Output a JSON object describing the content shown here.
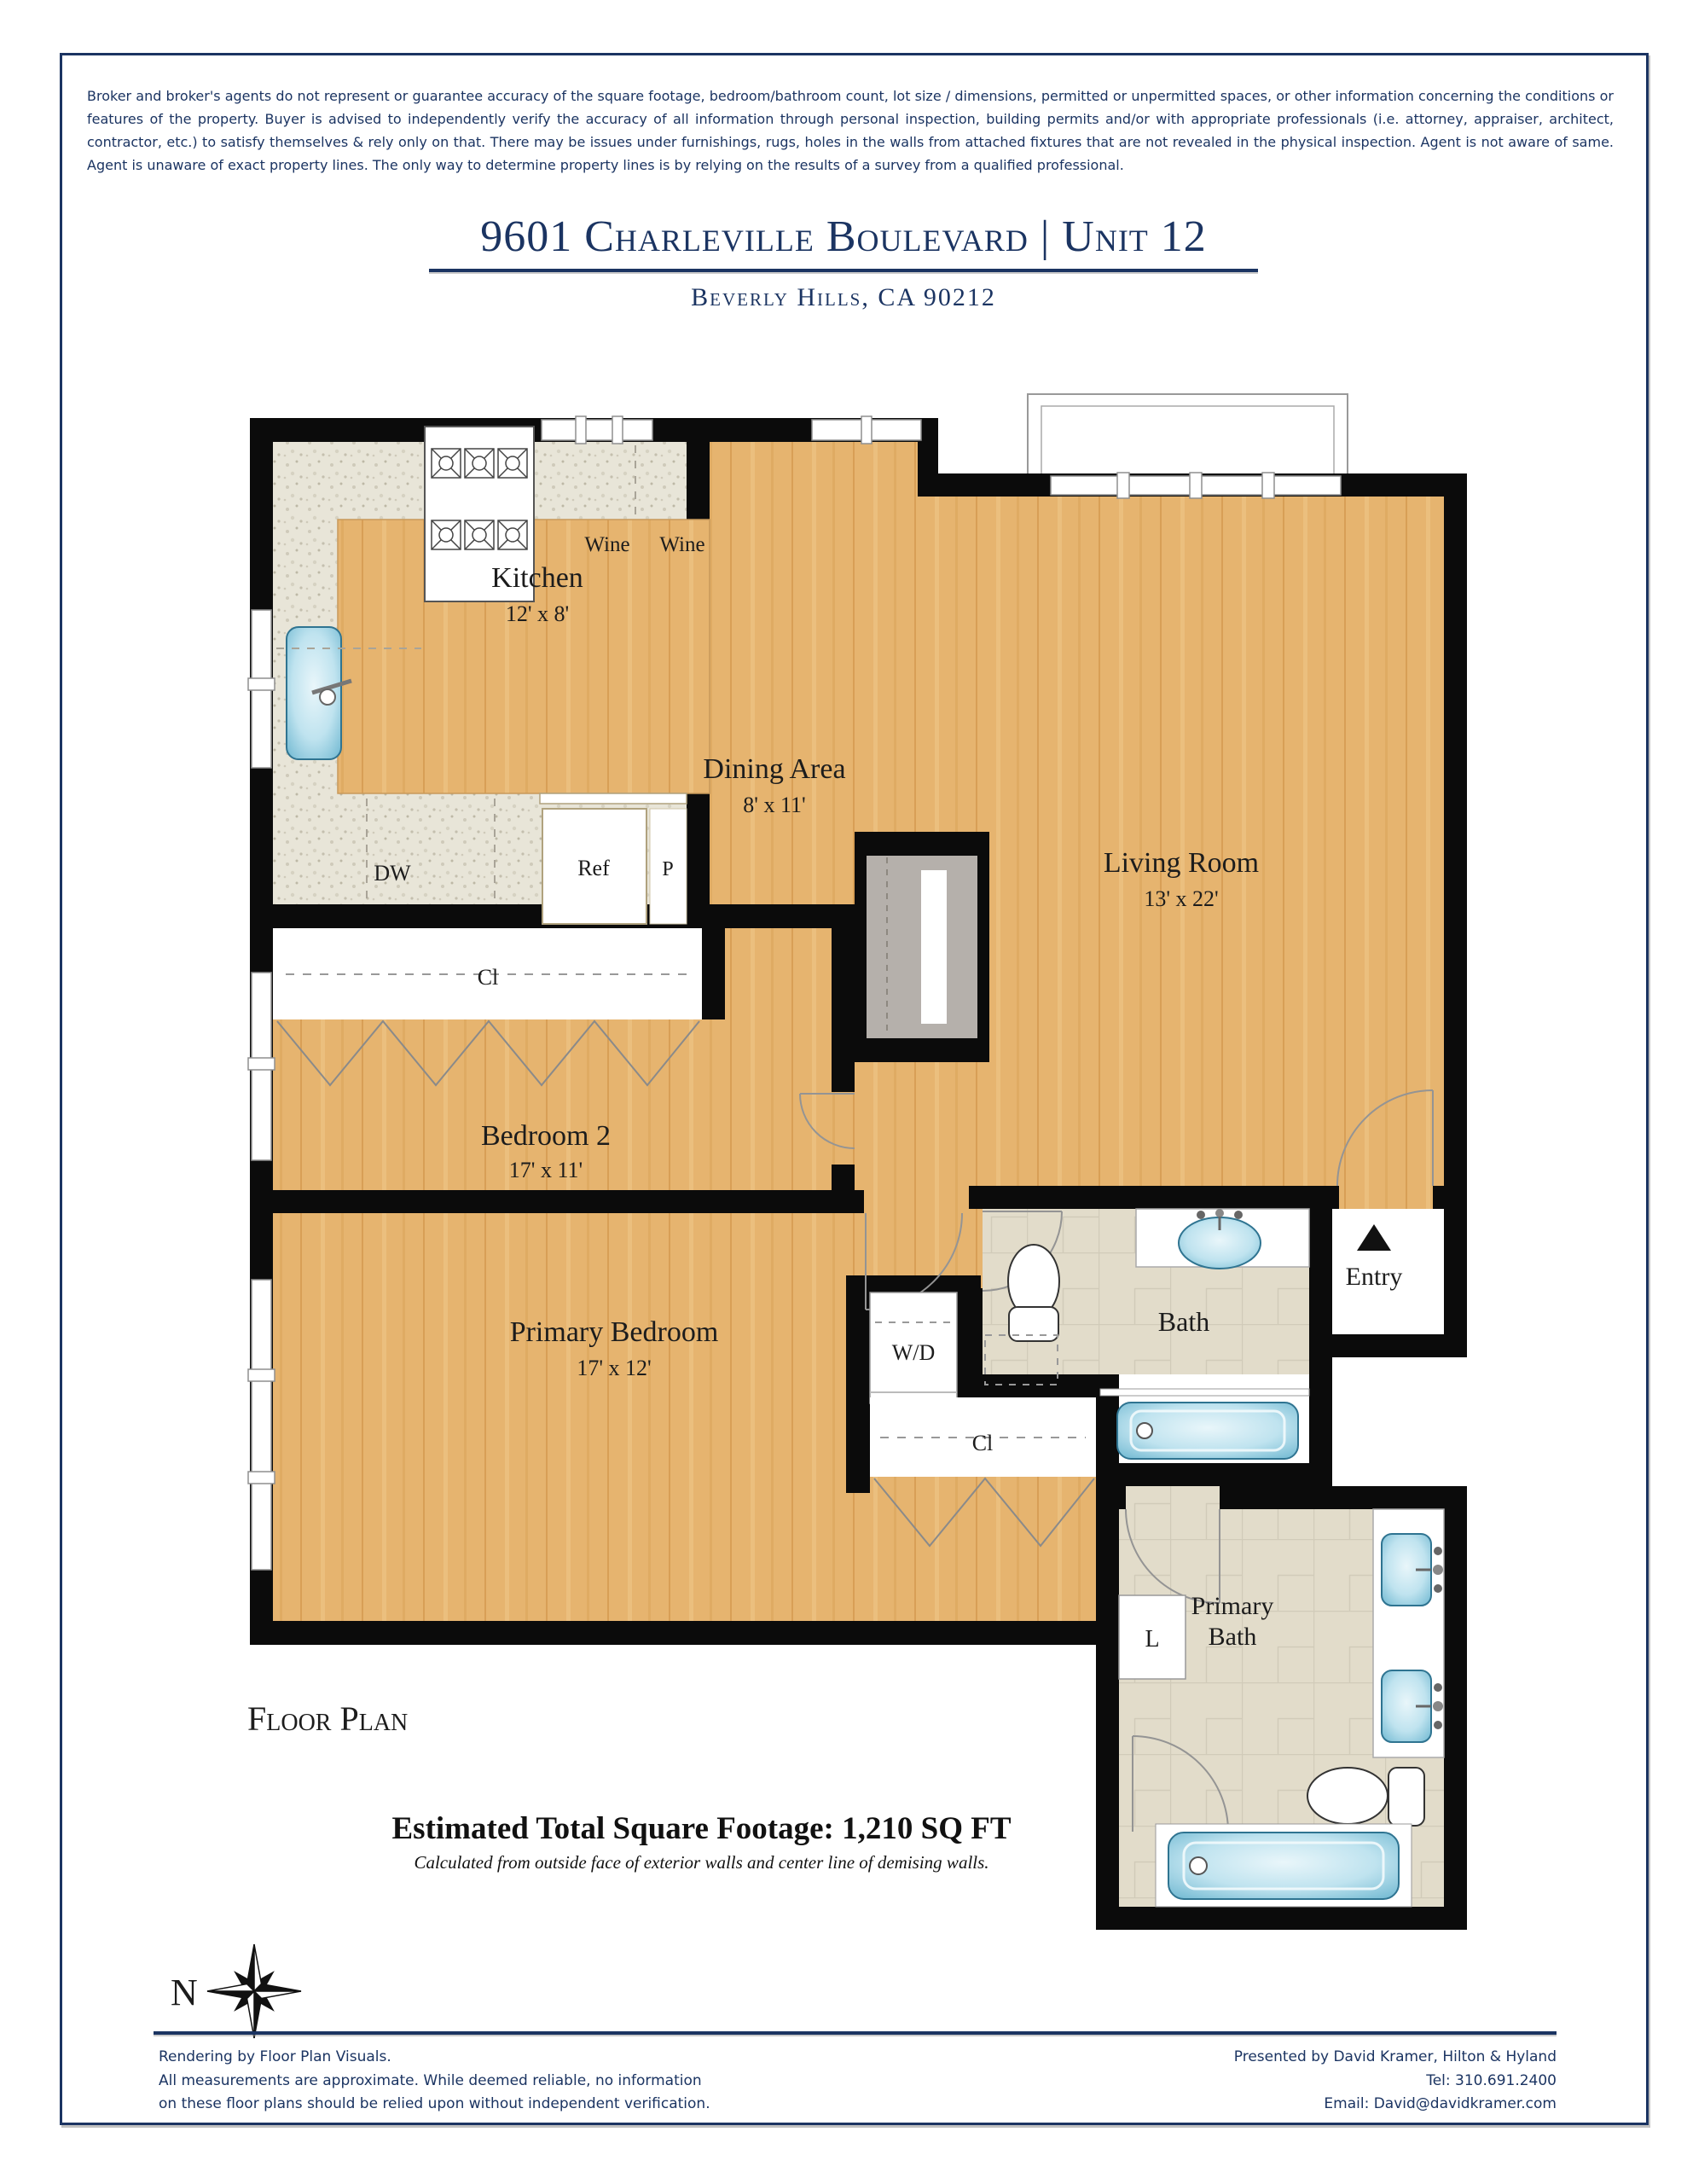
{
  "page": {
    "disclaimer": "Broker and broker's agents do not represent or guarantee accuracy of the square footage, bedroom/bathroom count, lot size / dimensions, permitted or unpermitted spaces, or other information concerning the conditions or features of the property. Buyer is advised to independently verify the accuracy of all information through personal inspection, building permits and/or with appropriate professionals (i.e. attorney, appraiser, architect, contractor, etc.) to satisfy themselves & rely only on that. There may be issues under furnishings, rugs, holes in the walls from attached fixtures that are not revealed in the physical inspection. Agent is not aware of same. Agent is unaware of exact property lines. The only way to determine property lines is by relying on the results of a survey from a qualified professional.",
    "title": "9601 Charleville Boulevard | Unit 12",
    "subtitle": "Beverly Hills, CA 90212",
    "floor_plan_label": "Floor Plan",
    "sqft_line": "Estimated Total Square Footage: 1,210 SQ FT",
    "sqft_note": "Calculated from outside face of exterior walls and center line of demising walls.",
    "compass_north": "N"
  },
  "rooms": {
    "kitchen": {
      "name": "Kitchen",
      "dims": "12' x 8'"
    },
    "dining": {
      "name": "Dining Area",
      "dims": "8' x 11'"
    },
    "living": {
      "name": "Living Room",
      "dims": "13' x 22'"
    },
    "bedroom2": {
      "name": "Bedroom 2",
      "dims": "17' x 11'"
    },
    "primary_bedroom": {
      "name": "Primary Bedroom",
      "dims": "17' x 12'"
    },
    "bath": {
      "name": "Bath"
    },
    "primary_bath": {
      "line1": "Primary",
      "line2": "Bath"
    },
    "entry": {
      "name": "Entry"
    }
  },
  "fixtures": {
    "wine_left": "Wine",
    "wine_right": "Wine",
    "dishwasher": "DW",
    "refrigerator": "Ref",
    "pantry": "P",
    "washer_dryer": "W/D",
    "closet_bedroom2": "Cl",
    "closet_primary": "Cl",
    "linen": "L"
  },
  "footer": {
    "left_line1": "Rendering by Floor Plan Visuals.",
    "left_line2": "All measurements are approximate. While deemed reliable, no information",
    "left_line3": "on these floor plans should be relied upon without independent verification.",
    "right_line1": "Presented by David Kramer, Hilton & Hyland",
    "right_line2": "Tel: 310.691.2400",
    "right_line3": "Email: David@davidkramer.com"
  },
  "colors": {
    "accent_navy": "#1b3462",
    "wall_black": "#0b0b0b",
    "wood_floor": "#e6b46f",
    "granite_floor": "#e8e5d8",
    "tile_floor": "#e2dcca",
    "fixture_blue": "#9fd3e4"
  }
}
